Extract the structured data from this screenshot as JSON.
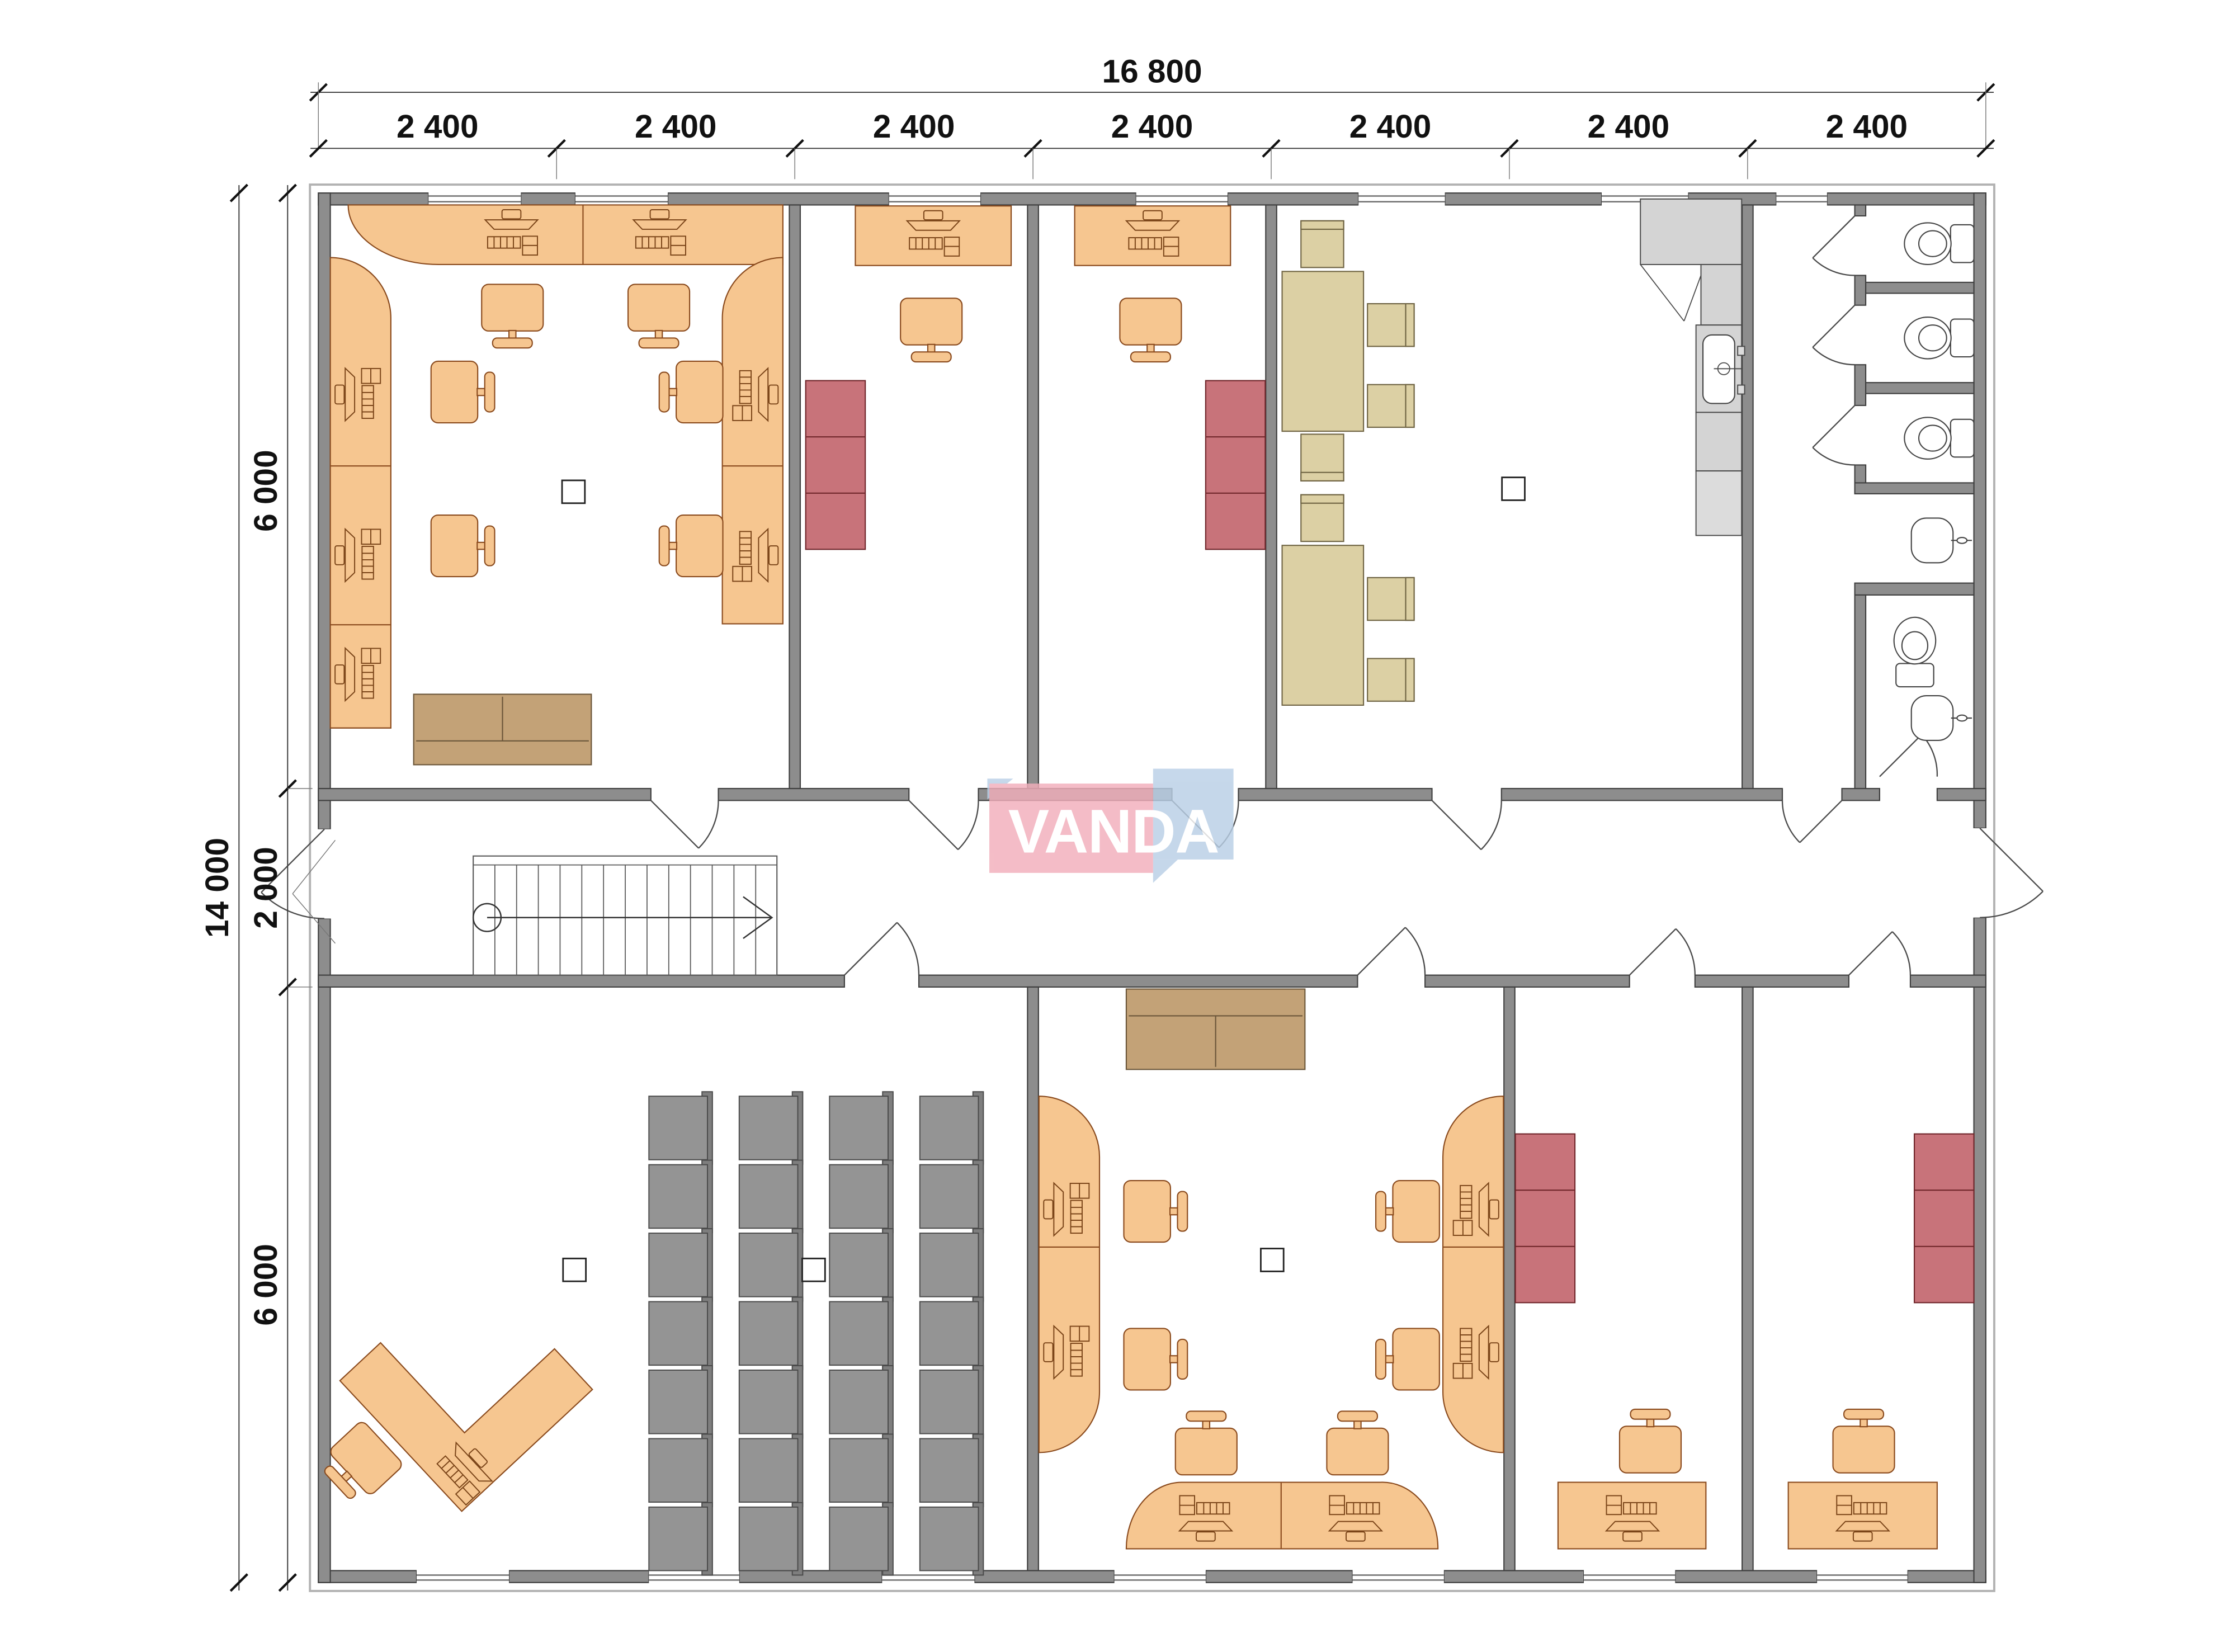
{
  "drawing": {
    "logo": {
      "text": "VANDA",
      "pink": "#F2AEBB",
      "blue": "#B9CFE6"
    },
    "dimensions": {
      "top_total": "16 800",
      "top_segments": [
        "2 400",
        "2 400",
        "2 400",
        "2 400",
        "2 400",
        "2 400",
        "2 400"
      ],
      "left_total": "14 000",
      "left_top": "6 000",
      "left_mid": "2 000",
      "left_bottom": "6 000"
    },
    "colors": {
      "wall": "#8d8d8d",
      "desk_orange": "#F6C690",
      "cabinet_red": "#C8737A",
      "table_beige": "#DCD0A4",
      "chair_gray": "#949494",
      "sofa_brown": "#C3A277",
      "kitchen_gray": "#d4d4d4",
      "logo_pink": "#F2AEBB",
      "logo_blue": "#B9CFE6"
    }
  }
}
